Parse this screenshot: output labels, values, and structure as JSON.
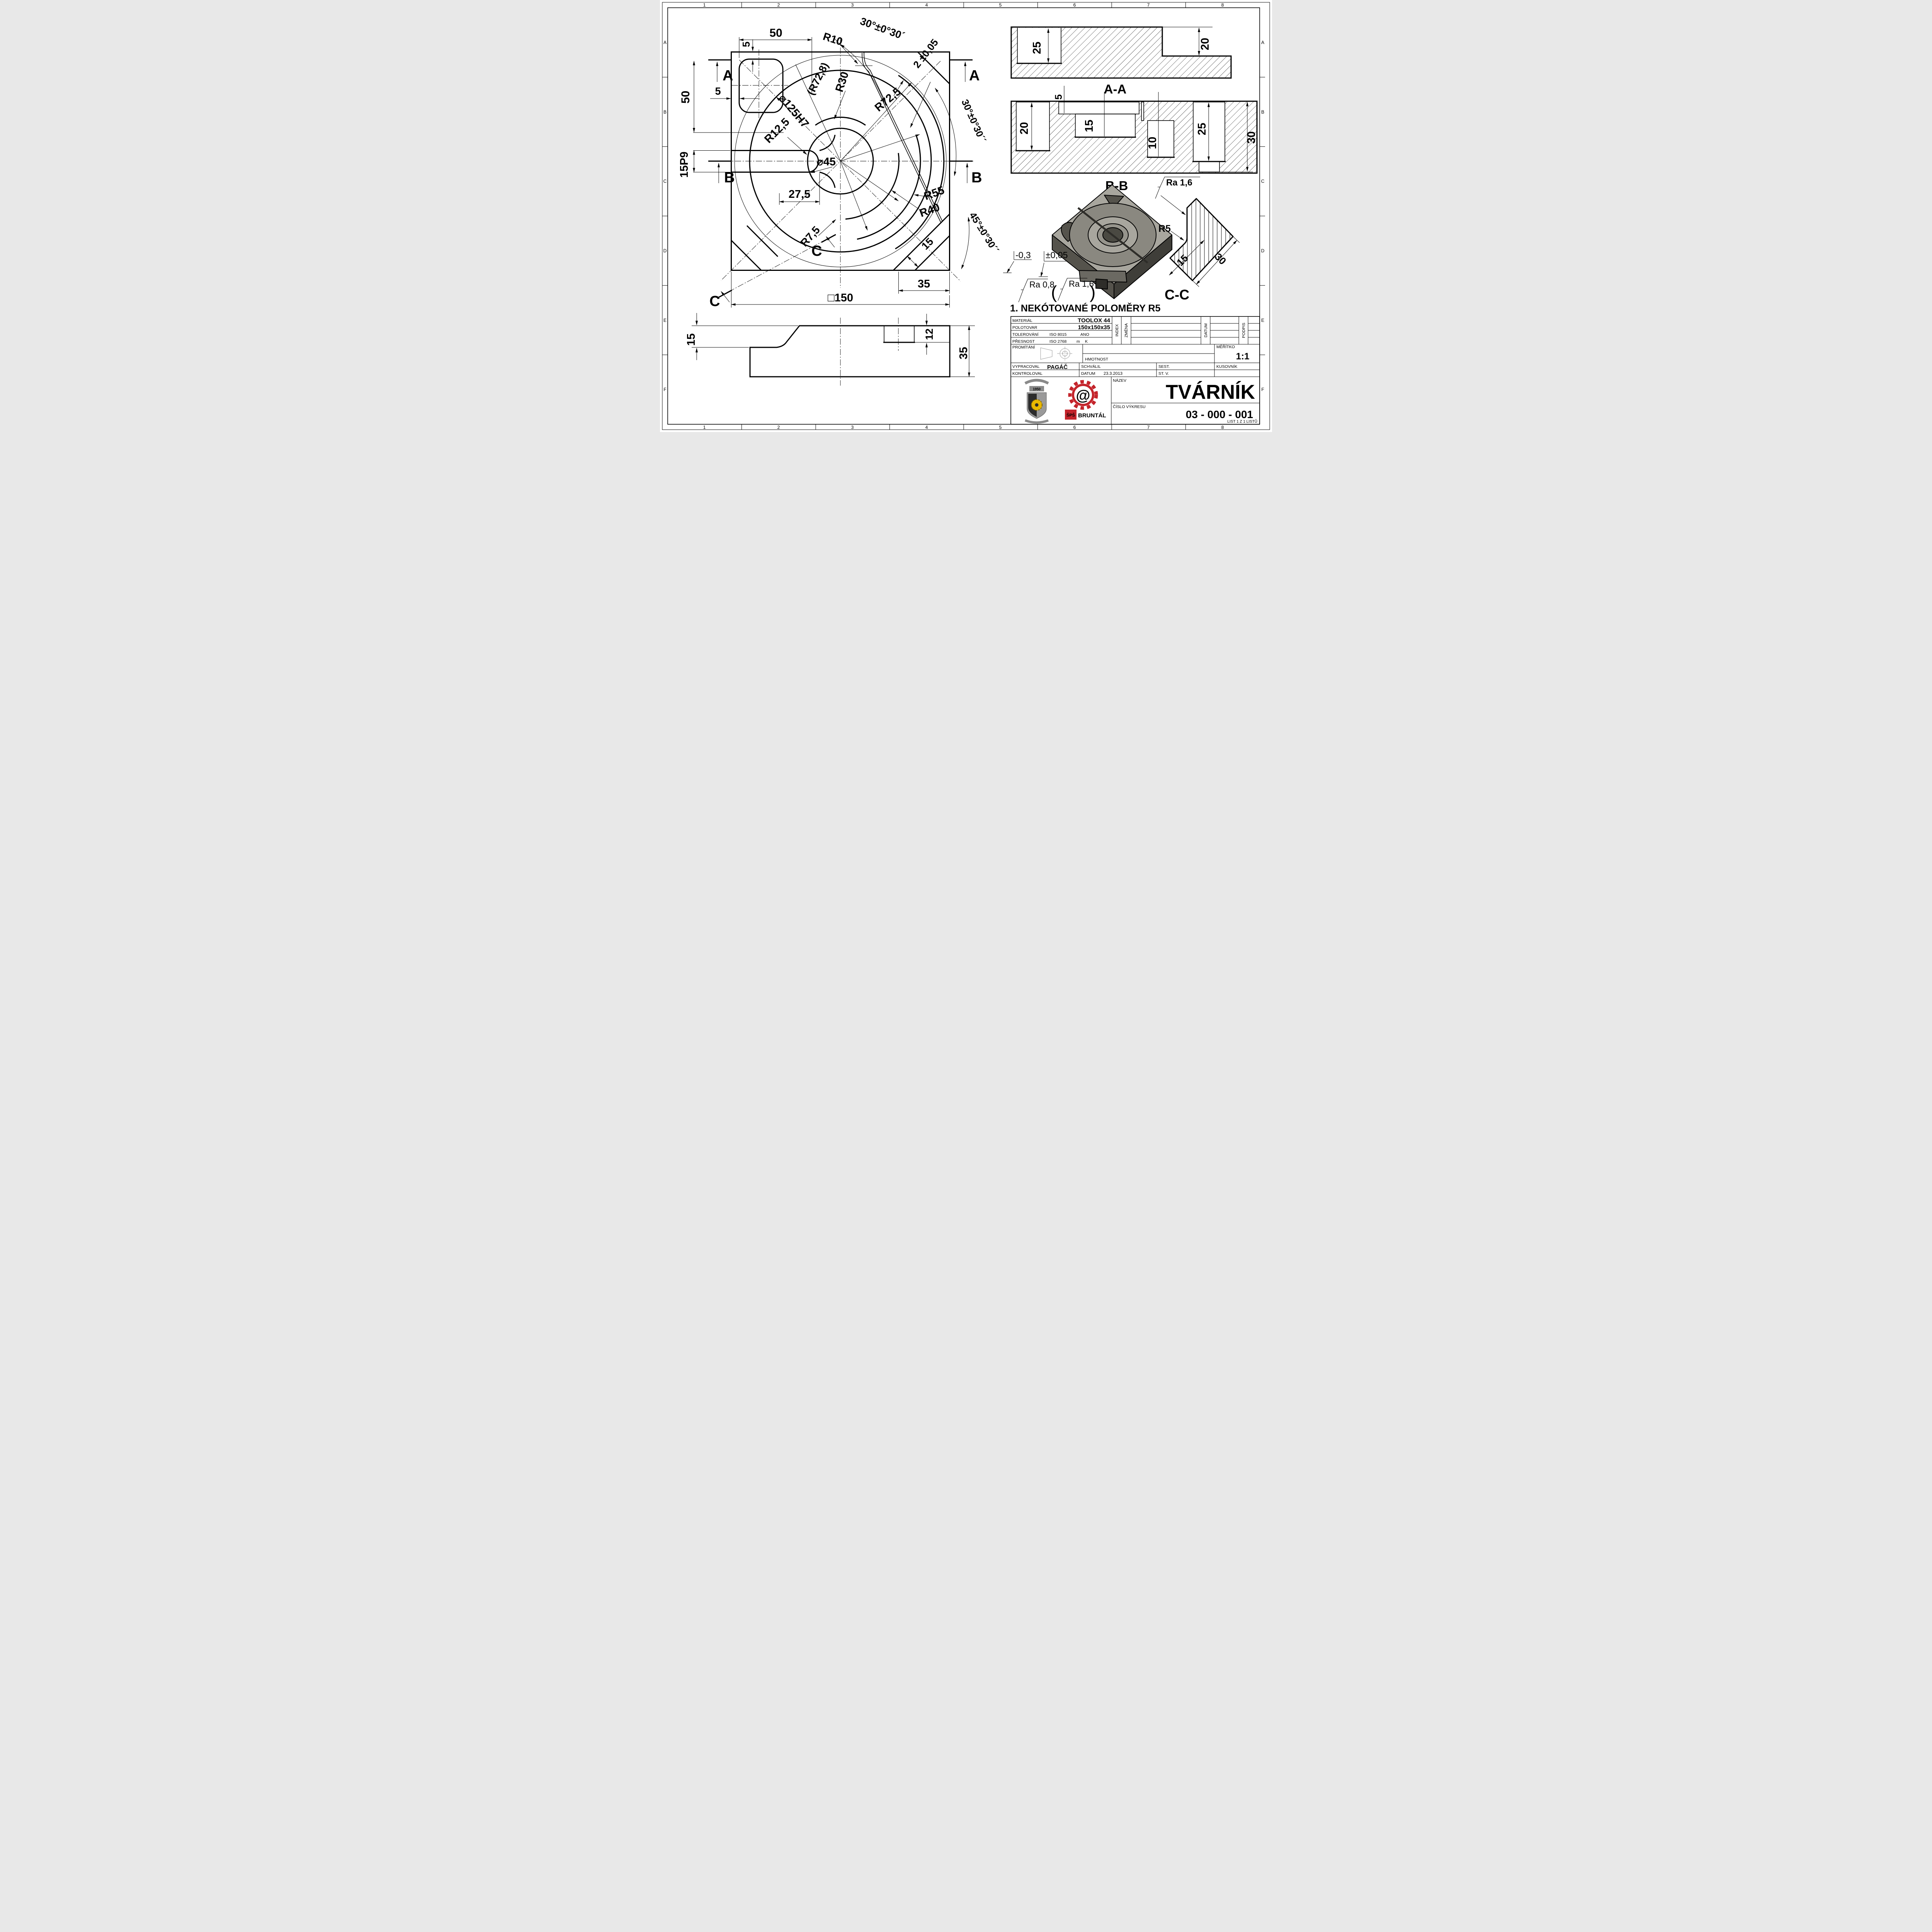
{
  "border": {
    "cols": [
      "1",
      "2",
      "3",
      "4",
      "5",
      "6",
      "7",
      "8"
    ],
    "rows": [
      "A",
      "B",
      "C",
      "D",
      "E",
      "F"
    ]
  },
  "t": {
    "d50_top": "50",
    "d5_top": "5",
    "r10": "R10",
    "a30_top": "30°±0°30´",
    "d2": "2 ±0,05",
    "secA": "A",
    "d50_left": "50",
    "d5_left": "5",
    "d125": "⌀125H7",
    "r72_8": "(R72,8)",
    "r30": "R30",
    "r72_5": "R72,5",
    "a30_right": "30°±0°30´´",
    "r12_5": "R12,5",
    "d15p9": "15P9",
    "secB": "B",
    "d45": "⌀45",
    "d27_5": "27,5",
    "r55": "R55",
    "r40": "R40",
    "r7_5": "R7,5",
    "secC": "C",
    "d15_band": "15",
    "a45": "45°±0°30´´",
    "d35": "35",
    "d150": "□150",
    "bv15": "15",
    "bv12": "12",
    "bv35": "35",
    "aa25": "25",
    "aa20": "20",
    "lblAA": "A-A",
    "bb20": "20",
    "bb5": "5",
    "bb15": "15",
    "bb10": "10",
    "bb25": "25",
    "bb30": "30",
    "lblBB": "B-B",
    "ra16": "Ra 1,6",
    "r5": "R5",
    "cc15": "15",
    "cc30": "30",
    "lblCC": "C-C",
    "tol_m03": "-0,3",
    "tol_005": "±0,05",
    "ra08": "Ra 0,8",
    "par_o": "(",
    "par_c": ")",
    "note": "1. NEKÓTOVANÉ POLOMĚRY R5"
  },
  "title_block": {
    "material_label": "MATERIÁL",
    "material": "TOOLOX 44",
    "polotovar_label": "POLOTOVAR",
    "polotovar": "150x150x35",
    "tolerovani_label": "TOLEROVÁNÍ",
    "tolerovani_std": "ISO 8015",
    "tolerovani_val": "ANO",
    "presnost_label": "PŘESNOST",
    "presnost_std": "ISO 2768",
    "presnost_m": "m",
    "presnost_k": "K",
    "promitani_label": "PROMÍTÁNÍ",
    "index_label": "INDEX",
    "zmena_label": "ZMĚNA",
    "datum_col_label": "DATUM",
    "podpis_label": "PODPIS",
    "hmotnost_label": "HMOTNOST",
    "meritko_label": "MĚŘÍTKO",
    "meritko": "1:1",
    "vypracoval_label": "VYPRACOVAL",
    "vypracoval": "PAGÁČ",
    "schvalil_label": "SCHVÁLIL",
    "kontroloval_label": "KONTROLOVAL",
    "datum_label": "DATUM",
    "datum": "23.3.2013",
    "sest_label": "SEST.",
    "kusovnik_label": "KUSOVNÍK",
    "stv_label": "ST. V.",
    "nazev_label": "NÁZEV",
    "nazev": "TVÁRNÍK",
    "cislo_label": "ČÍSLO VÝKRESU",
    "cislo": "03 - 000 - 001",
    "list": "LIST 1 Z 1 LISTŮ",
    "logo_year": "1950",
    "logo_sps": "ŠPŠ",
    "logo_bruntal": "BRUNTÁL",
    "logo_at": "@"
  },
  "colors": {
    "logo_red": "#c4242b",
    "gear_yellow": "#e8b800",
    "part_top": "#a8a69e",
    "part_side": "#55534c"
  }
}
